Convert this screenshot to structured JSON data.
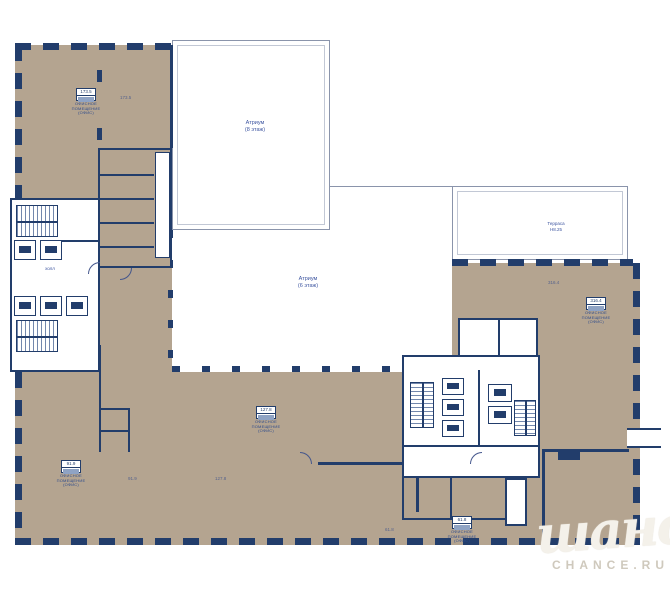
{
  "plan": {
    "atrium_upper": {
      "line1": "Атриум",
      "line2": "(8 этаж)"
    },
    "atrium_center": {
      "line1": "Атриум",
      "line2": "(6 этаж)"
    },
    "terrace": {
      "line1": "Терраса",
      "line2": "Н8.25"
    },
    "hall_label": "холл",
    "office_label": {
      "line1": "ОФИСНОЕ",
      "line2": "ПОМЕЩЕНИЕ",
      "line3": "(ОФИС)"
    },
    "stamps": [
      {
        "value": "173.5"
      },
      {
        "value": "127.8"
      },
      {
        "value": "91.9"
      },
      {
        "value": "316.4"
      },
      {
        "value": "61.8"
      }
    ],
    "areas": [
      {
        "value": "173.5"
      },
      {
        "value": "91.9"
      },
      {
        "value": "61.8"
      },
      {
        "value": "316.4"
      },
      {
        "value": "127.8"
      }
    ]
  },
  "watermark": {
    "script": "шанс",
    "caption": "CHANCE.RU"
  },
  "colors": {
    "floor_beige": "#b4a490",
    "wall_navy": "#223d6b",
    "label_blue": "#3d55a0",
    "watermark_ivory": "#f4f1ea"
  }
}
